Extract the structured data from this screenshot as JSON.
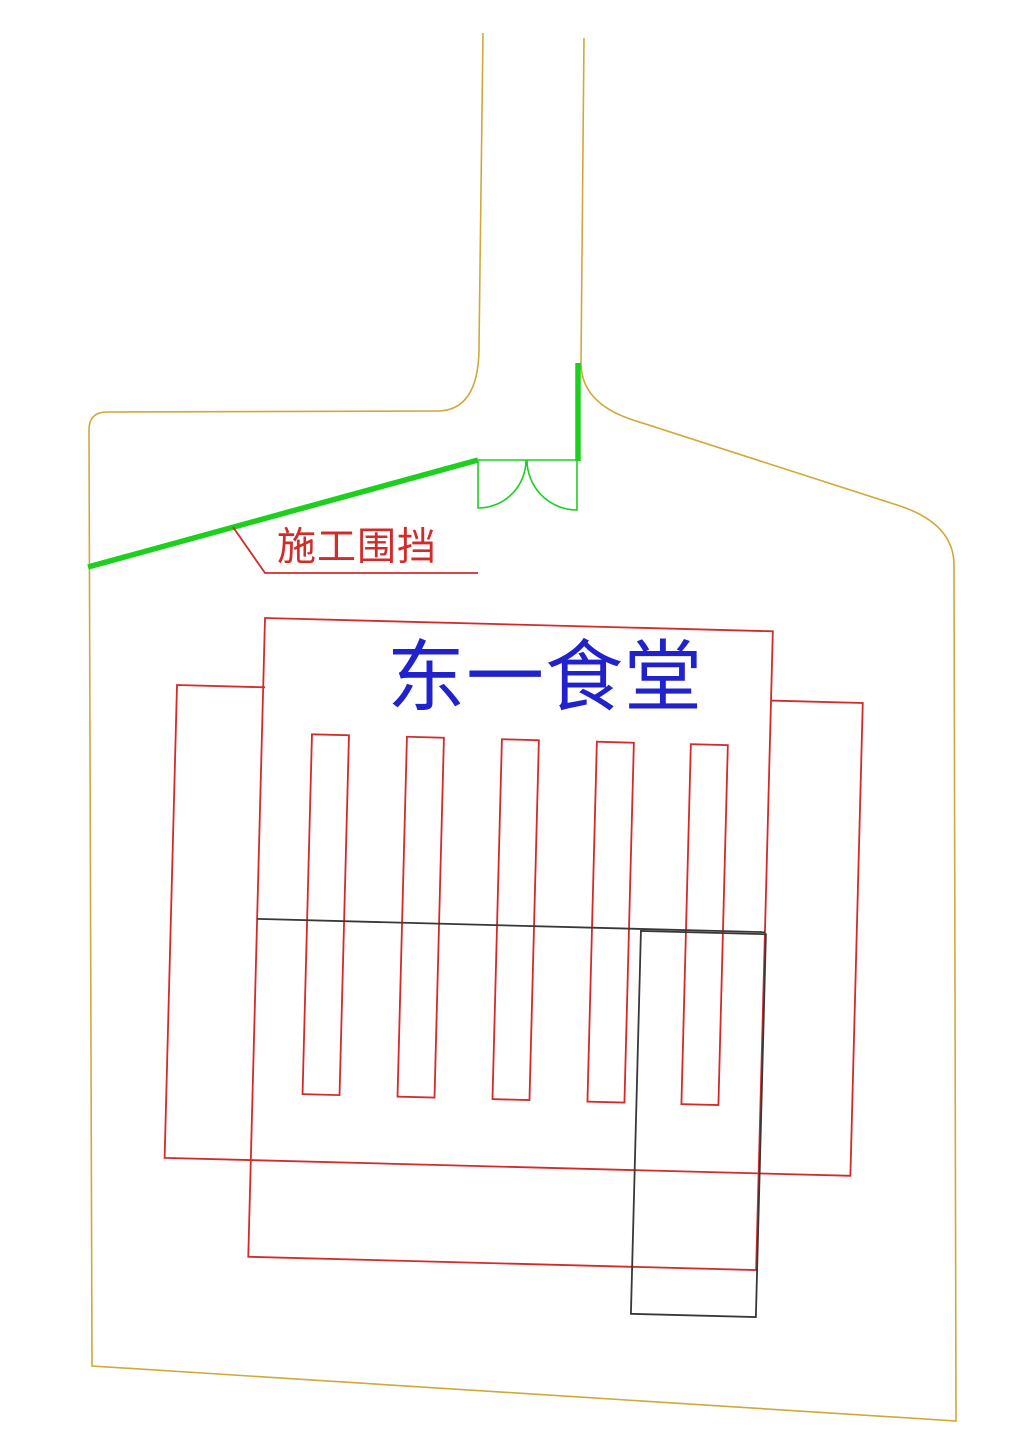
{
  "labels": {
    "building_title": {
      "text": "东一食堂"
    },
    "fence_annotation": {
      "text": "施工围挡"
    }
  },
  "colors": {
    "site_boundary_yellow": "#d1a939",
    "fence_green": "#1ed01e",
    "building_red": "#d42a2a",
    "outline_black": "#383838",
    "title_blue": "#2222cc",
    "background_white": "#ffffff"
  }
}
